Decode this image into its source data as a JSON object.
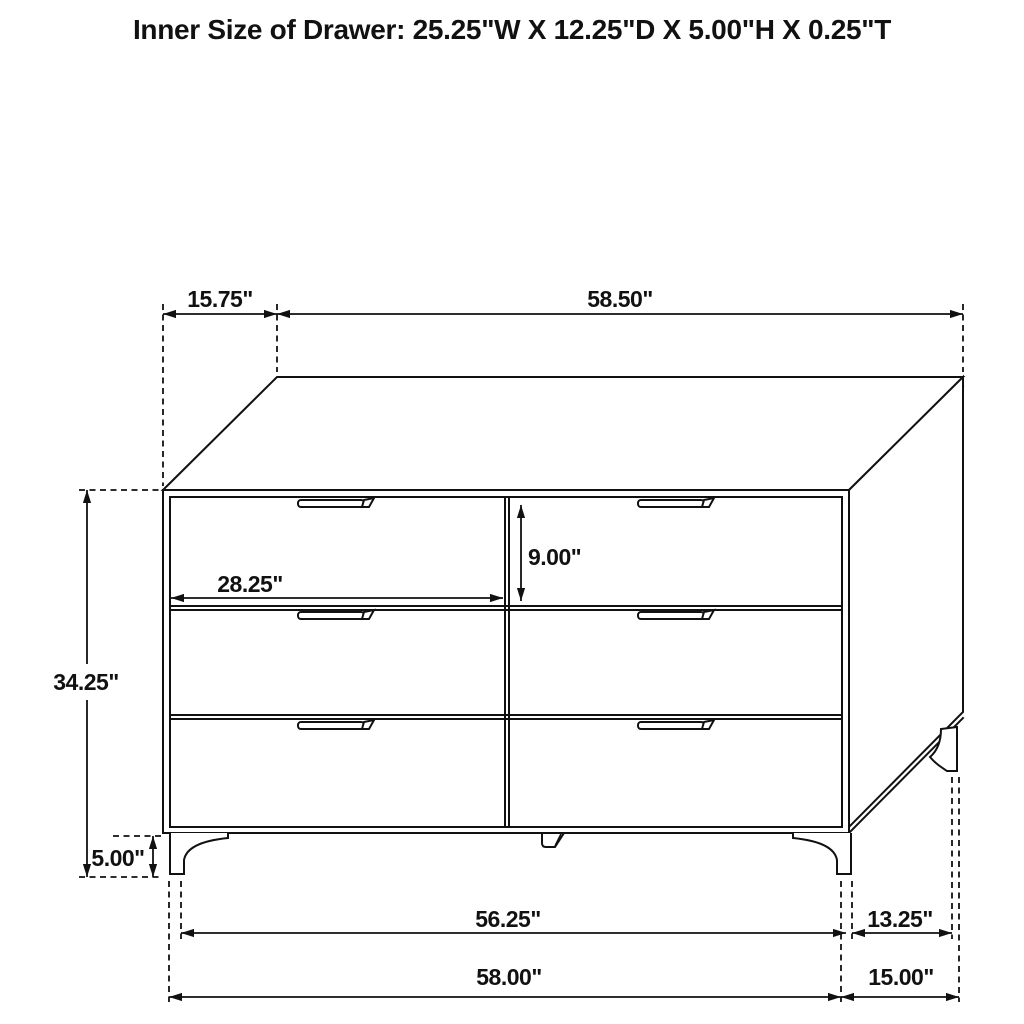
{
  "title": "Inner Size of Drawer: 25.25\"W X 12.25\"D X 5.00\"H X 0.25\"T",
  "diagram": {
    "item": "six-drawer-dresser-dimension-drawing",
    "line_color": "#111111",
    "background_color": "#ffffff",
    "labels": {
      "top_depth": "15.75\"",
      "top_width": "58.50\"",
      "body_height": "34.25\"",
      "leg_height": "5.00\"",
      "drawer_width": "28.25\"",
      "drawer_height": "9.00\"",
      "front_leg_span": "56.25\"",
      "side_leg_span": "13.25\"",
      "front_overall_width": "58.00\"",
      "side_overall_depth": "15.00\""
    }
  }
}
